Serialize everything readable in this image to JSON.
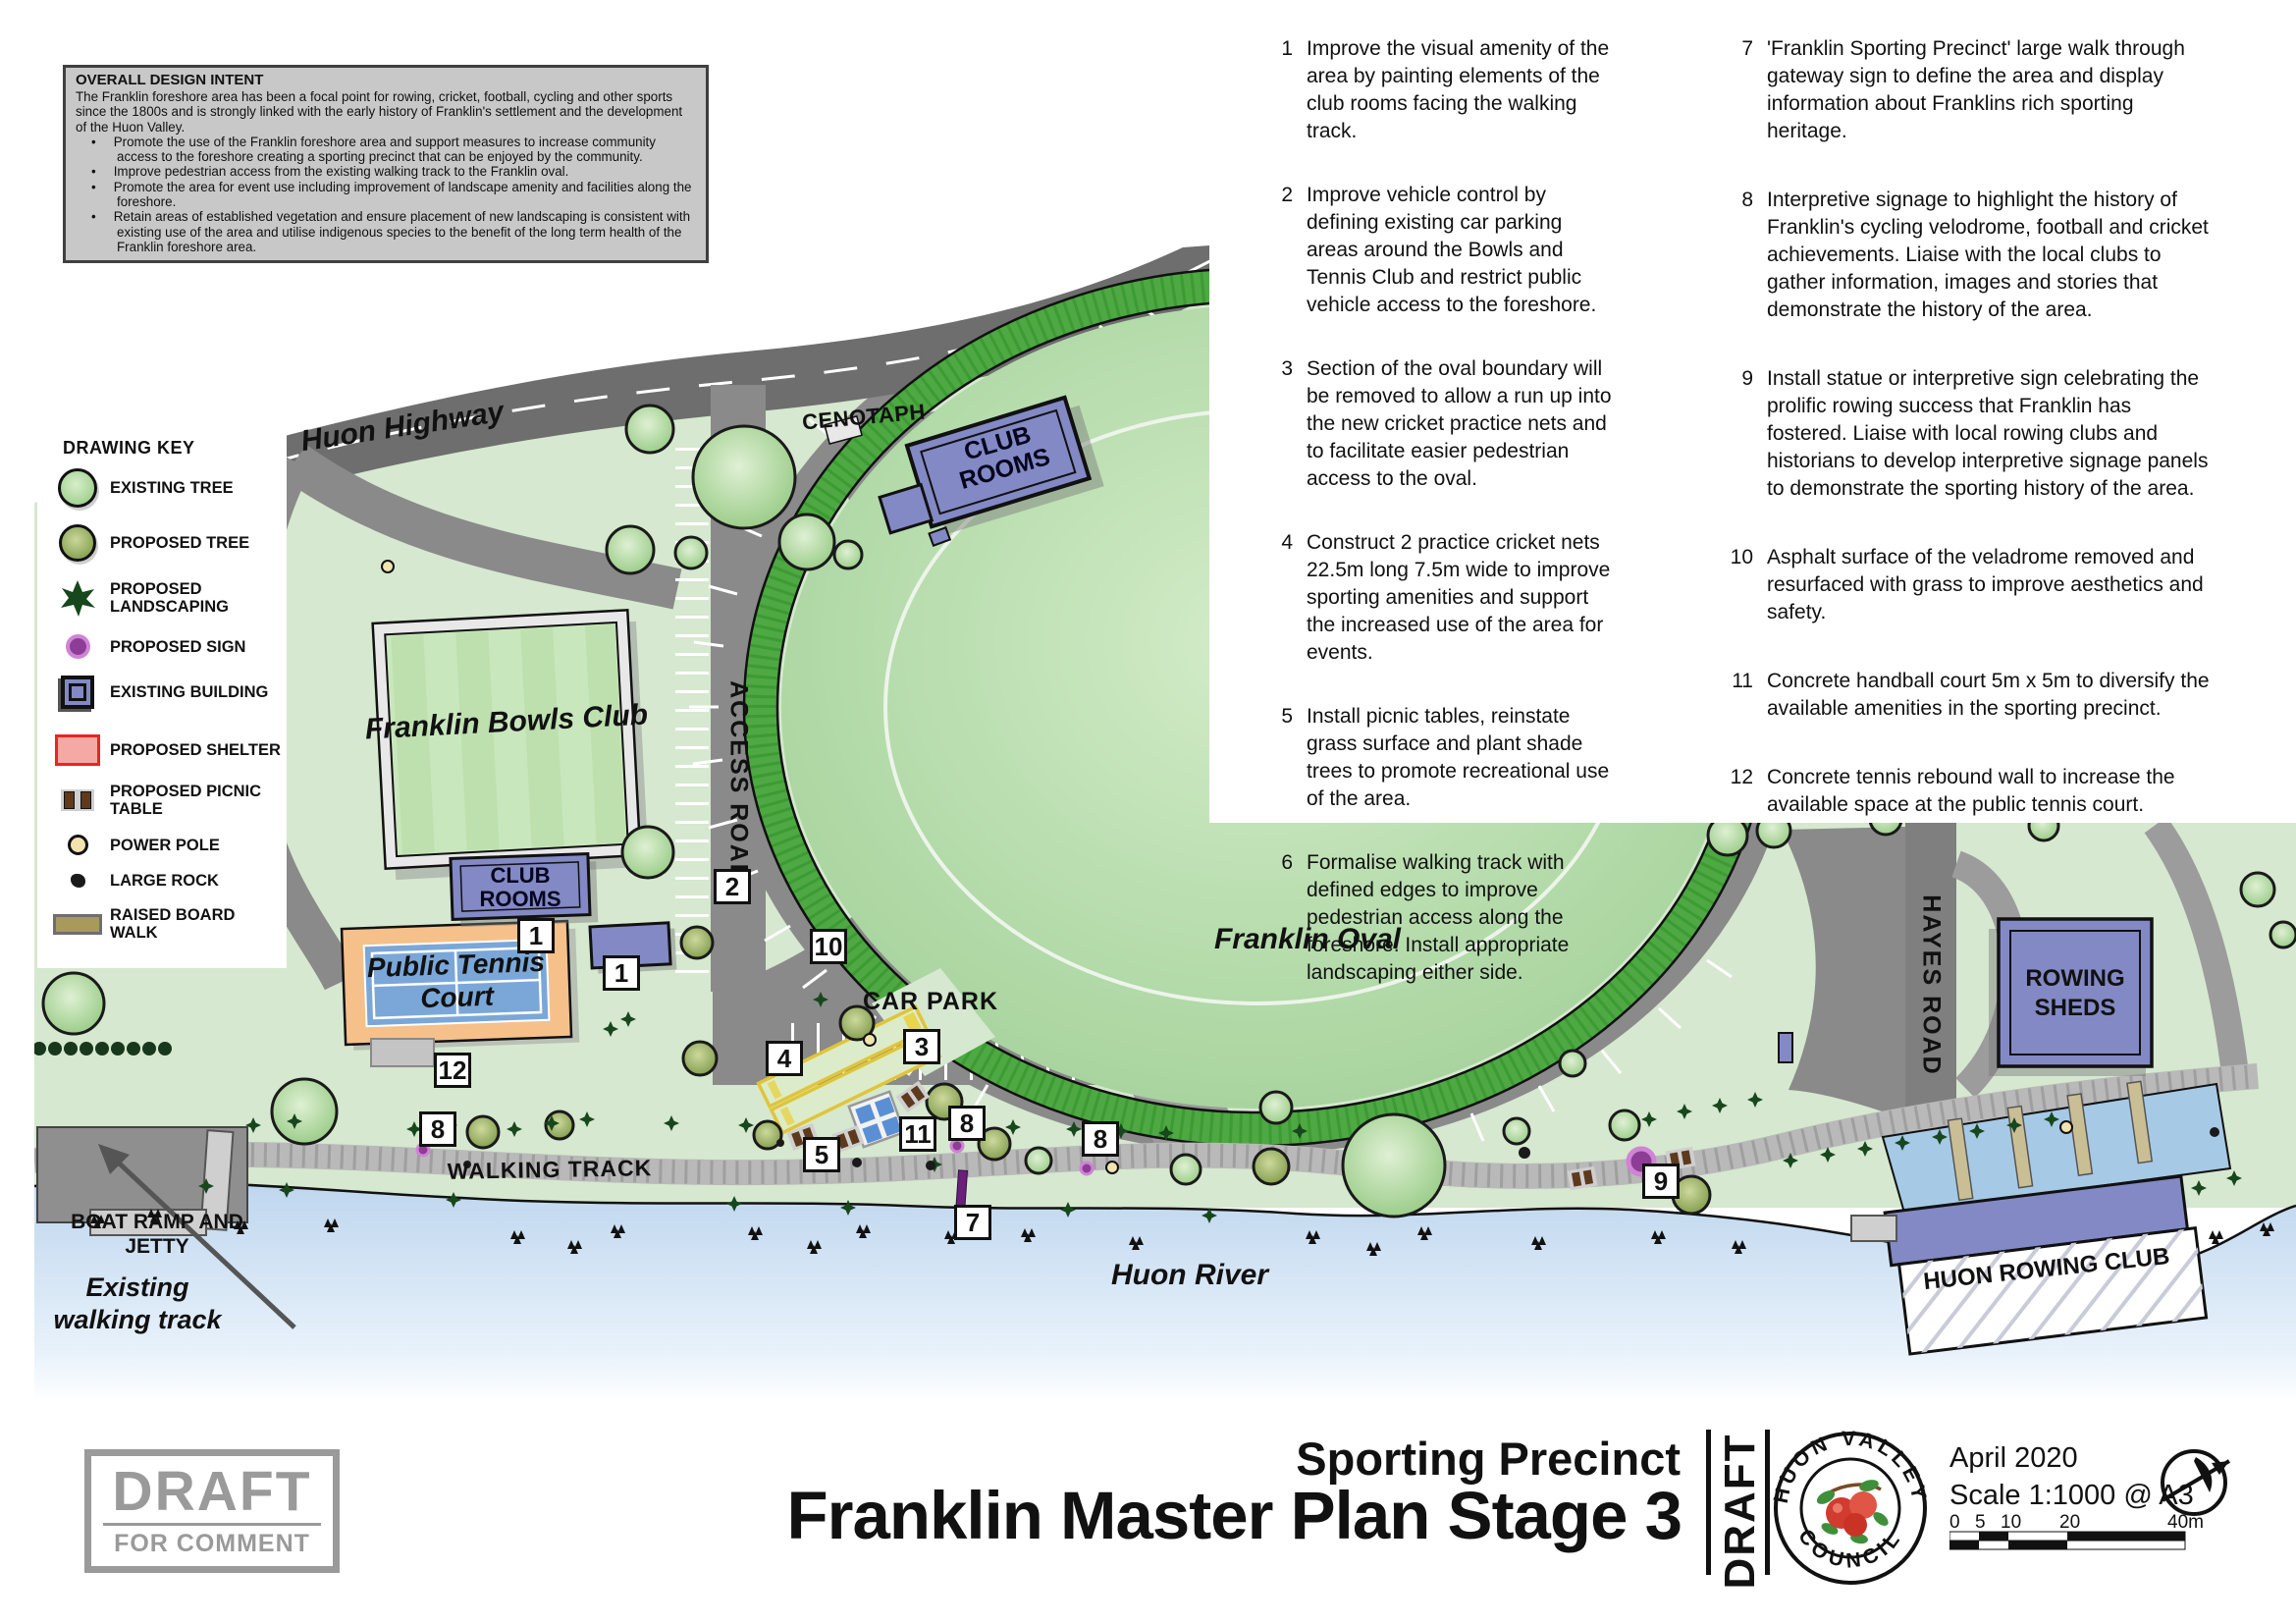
{
  "design_intent": {
    "title": "OVERALL DESIGN INTENT",
    "intro": "The Franklin foreshore area has been a focal point for rowing, cricket, football, cycling and other sports since the 1800s and is strongly linked with the early history of Franklin's settlement and the development of the Huon Valley.",
    "bullets": [
      "Promote the use of the Franklin foreshore area and support measures to increase community access to the foreshore creating a sporting precinct that can be enjoyed by the community.",
      "Improve pedestrian access from the existing walking track to the Franklin oval.",
      "Promote the area for event use including improvement of landscape amenity and facilities along the foreshore.",
      "Retain areas of established vegetation and ensure placement of new landscaping is consistent with existing use of the area and utilise indigenous species to the benefit of the long term health of the Franklin foreshore area."
    ]
  },
  "action_items": {
    "col1": [
      {
        "num": "1",
        "text": "Improve the visual amenity of the area by painting elements of the club rooms facing the walking track."
      },
      {
        "num": "2",
        "text": "Improve vehicle control by defining existing car parking areas around the Bowls and Tennis Club and restrict public vehicle access to the foreshore."
      },
      {
        "num": "3",
        "text": "Section of the oval boundary will be removed to allow a run up into the new cricket practice nets and to facilitate easier pedestrian access to the oval."
      },
      {
        "num": "4",
        "text": "Construct 2 practice cricket nets 22.5m long 7.5m wide to improve sporting amenities and support the increased use of the area for events."
      },
      {
        "num": "5",
        "text": "Install picnic tables, reinstate grass surface and plant shade trees to promote recreational use of the area."
      },
      {
        "num": "6",
        "text": "Formalise walking track with defined edges to improve pedestrian access along the foreshore. Install appropriate landscaping either side."
      }
    ],
    "col2": [
      {
        "num": "7",
        "text": "'Franklin Sporting Precinct' large walk through gateway sign to define the area and display information about Franklins rich sporting heritage."
      },
      {
        "num": "8",
        "text": "Interpretive signage to highlight the history of Franklin's cycling velodrome, football and cricket achievements. Liaise with the local clubs to gather information, images and stories that demonstrate the history of the area."
      },
      {
        "num": "9",
        "text": "Install statue or interpretive sign celebrating the prolific rowing success that Franklin has fostered. Liaise with local rowing clubs and historians to develop interpretive signage panels to demonstrate the sporting history of the area."
      },
      {
        "num": "10",
        "text": "Asphalt surface of the veladrome removed and resurfaced with grass to improve aesthetics and safety."
      },
      {
        "num": "11",
        "text": "Concrete handball court 5m x 5m to diversify the available amenities in the sporting precinct."
      },
      {
        "num": "12",
        "text": "Concrete tennis rebound wall to increase the available space at the public tennis court."
      }
    ]
  },
  "drawing_key": {
    "title": "DRAWING KEY",
    "items": [
      {
        "icon": "existing-tree-icon",
        "label": "EXISTING TREE"
      },
      {
        "icon": "proposed-tree-icon",
        "label": "PROPOSED TREE"
      },
      {
        "icon": "proposed-landscaping-icon",
        "label": "PROPOSED LANDSCAPING"
      },
      {
        "icon": "proposed-sign-icon",
        "label": "PROPOSED SIGN"
      },
      {
        "icon": "existing-building-icon",
        "label": "EXISTING BUILDING"
      },
      {
        "icon": "proposed-shelter-icon",
        "label": "PROPOSED SHELTER"
      },
      {
        "icon": "proposed-picnic-table-icon",
        "label": "PROPOSED PICNIC TABLE"
      },
      {
        "icon": "power-pole-icon",
        "label": "POWER POLE"
      },
      {
        "icon": "large-rock-icon",
        "label": "LARGE ROCK"
      },
      {
        "icon": "raised-board-walk-icon",
        "label": "RAISED BOARD WALK"
      }
    ]
  },
  "map_labels": {
    "huon_highway": "Huon Highway",
    "cenotaph": "CENOTAPH",
    "club_rooms_top": "CLUB ROOMS",
    "access_road": "ACCESS ROAD",
    "franklin_bowls_club": "Franklin Bowls Club",
    "club_rooms_bowls": "CLUB ROOMS",
    "public_tennis_court": "Public Tennis Court",
    "car_park": "CAR PARK",
    "walking_track": "WALKING TRACK",
    "boat_ramp_and_jetty": "BOAT RAMP AND JETTY",
    "existing_walking_track": "Existing walking track",
    "huon_river": "Huon River",
    "franklin_oval": "Franklin Oval",
    "hayes_road": "HAYES ROAD",
    "rowing_sheds": "ROWING SHEDS",
    "huon_rowing_club": "HUON ROWING CLUB"
  },
  "markers": [
    {
      "num": "2"
    },
    {
      "num": "1"
    },
    {
      "num": "1"
    },
    {
      "num": "10"
    },
    {
      "num": "4"
    },
    {
      "num": "3"
    },
    {
      "num": "12"
    },
    {
      "num": "8"
    },
    {
      "num": "5"
    },
    {
      "num": "11"
    },
    {
      "num": "8"
    },
    {
      "num": "8"
    },
    {
      "num": "7"
    },
    {
      "num": "9"
    }
  ],
  "title_block": {
    "stamp_line1": "DRAFT",
    "stamp_line2": "FOR COMMENT",
    "subtitle": "Sporting Precinct",
    "title": "Franklin Master Plan Stage 3",
    "side_label": "DRAFT",
    "council_arc_top": "HUON VALLEY",
    "council_arc_bottom": "COUNCIL",
    "date": "April 2020",
    "scale": "Scale 1:1000 @ A3",
    "scale_ticks": [
      "0",
      "5",
      "10",
      "20",
      "40m"
    ]
  },
  "colors": {
    "land": "#d6e8cf",
    "oval_field": "#b7dcab",
    "velodrome_green": "#4ea843",
    "road_grey": "#8a8a8a",
    "highway_grey": "#6e6e6e",
    "water_blue": "#c3d9ef",
    "building_blue": "#8289c4",
    "tennis_orange": "#f6c08b",
    "tennis_blue": "#7aa7d8",
    "sign_purple": "#8e3d96",
    "shelter_red": "#e8261f"
  }
}
